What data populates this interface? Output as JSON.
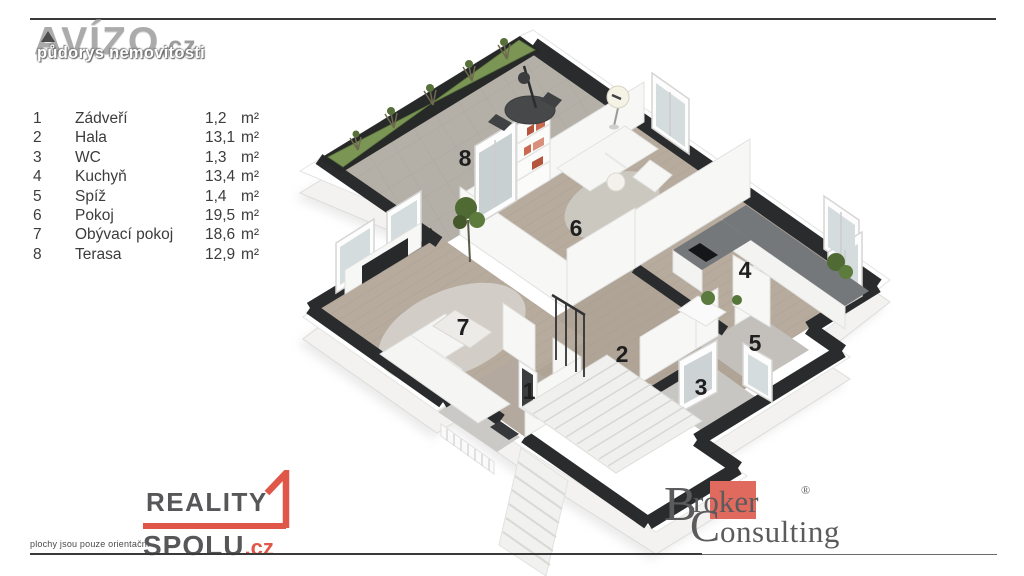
{
  "header": {
    "brand": "AVÍZO",
    "brand_tld": ".cz",
    "subtitle": "půdorys nemovitosti"
  },
  "legend": {
    "rows": [
      {
        "num": "1",
        "name": "Zádveří",
        "area": "1,2",
        "unit": "m²"
      },
      {
        "num": "2",
        "name": "Hala",
        "area": "13,1",
        "unit": "m²"
      },
      {
        "num": "3",
        "name": "WC",
        "area": "1,3",
        "unit": "m²"
      },
      {
        "num": "4",
        "name": "Kuchyň",
        "area": "13,4",
        "unit": "m²"
      },
      {
        "num": "5",
        "name": "Spíž",
        "area": "1,4",
        "unit": "m²"
      },
      {
        "num": "6",
        "name": "Pokoj",
        "area": "19,5",
        "unit": "m²"
      },
      {
        "num": "7",
        "name": "Obývací pokoj",
        "area": "18,6",
        "unit": "m²"
      },
      {
        "num": "8",
        "name": "Terasa",
        "area": "12,9",
        "unit": "m²"
      }
    ]
  },
  "plan": {
    "room_numbers": {
      "r1": "1",
      "r2": "2",
      "r3": "3",
      "r4": "4",
      "r5": "5",
      "r6": "6",
      "r7": "7",
      "r8": "8"
    }
  },
  "footer_left": {
    "disclaimer": "plochy jsou pouze orientační",
    "brand_line1": "REALITY",
    "brand_line2": "SPOLU",
    "brand_tld": ".cz"
  },
  "footer_right": {
    "b_initial": "B",
    "roker": "roker",
    "registered": "®",
    "c_initial": "C",
    "onsulting": "onsulting"
  },
  "colors": {
    "accent_red": "#e0574a",
    "broker_salmon": "#e06a5e",
    "wall_black": "#292b2c",
    "wood_floor": "#b7ab9e",
    "terrace_floor": "#b4afa7",
    "grass_green": "#7a9554"
  }
}
